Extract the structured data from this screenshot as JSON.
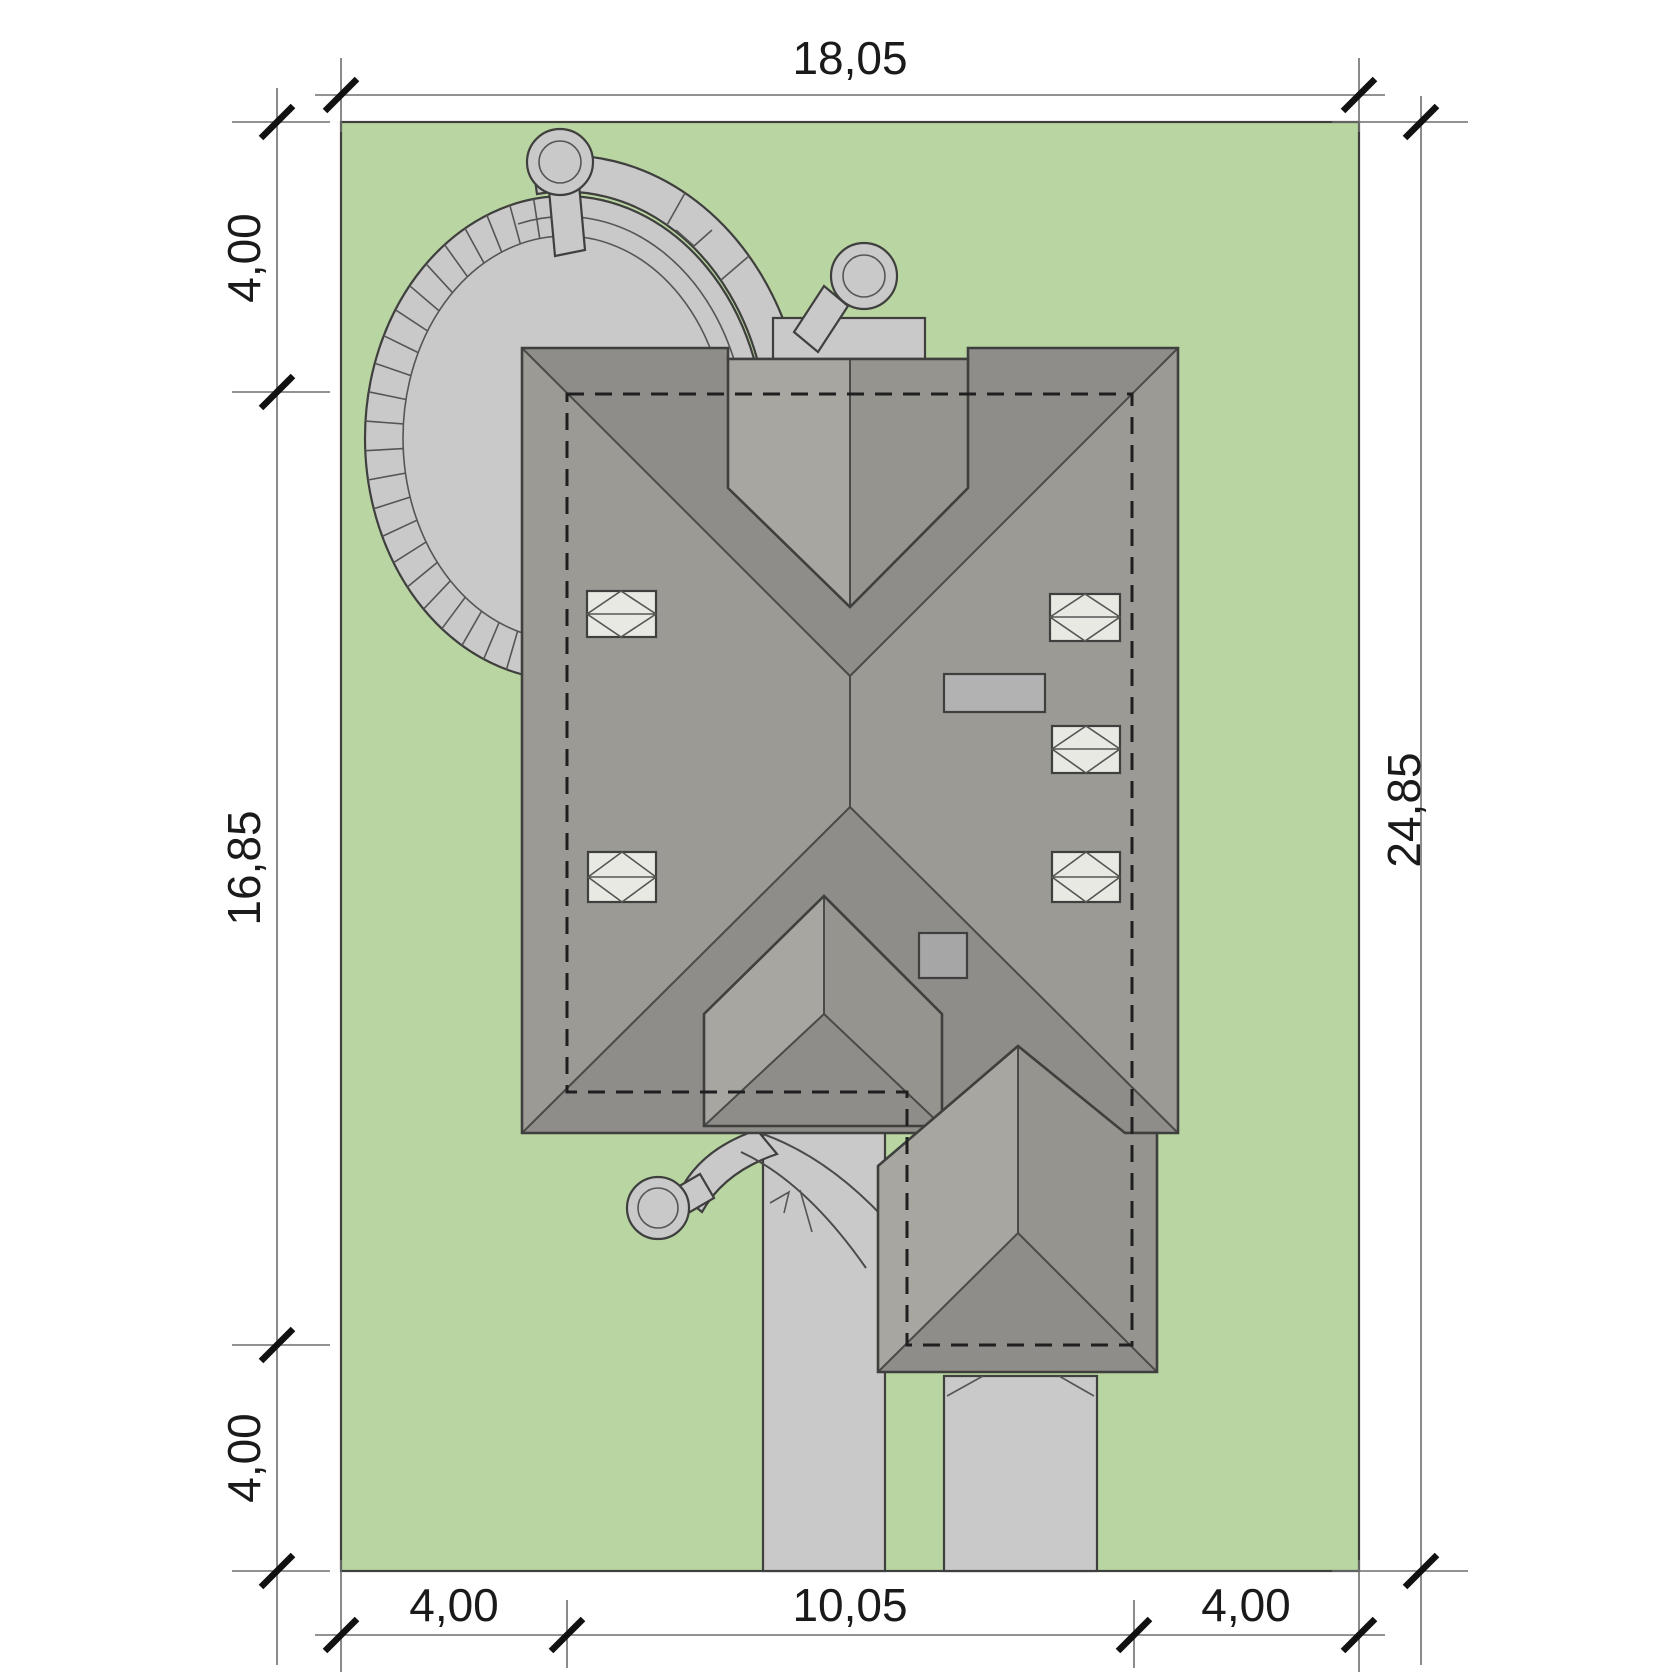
{
  "drawing": {
    "type": "house-site-plan-top-view"
  },
  "colors": {
    "background": "#ffffff",
    "plot_green": "#b8d5a2",
    "paving": "#c9c9c9",
    "paving_inner": "#c3c3c3",
    "roof_mid": "#9c9a95",
    "roof_dark": "#8f8d89",
    "roof_light": "#a8a6a1",
    "roof_shaded": "#96948f",
    "skylight": "#e9e9e4",
    "chimney": "#b2b2b2",
    "vent": "#a6a6a6"
  },
  "dimensions": {
    "top": {
      "label": "18,05"
    },
    "right": {
      "label": "24,85"
    },
    "left": {
      "segments": [
        {
          "label": "4,00"
        },
        {
          "label": "16,85"
        },
        {
          "label": "4,00"
        }
      ]
    },
    "bottom": {
      "segments": [
        {
          "label": "4,00"
        },
        {
          "label": "10,05"
        },
        {
          "label": "4,00"
        }
      ]
    }
  }
}
